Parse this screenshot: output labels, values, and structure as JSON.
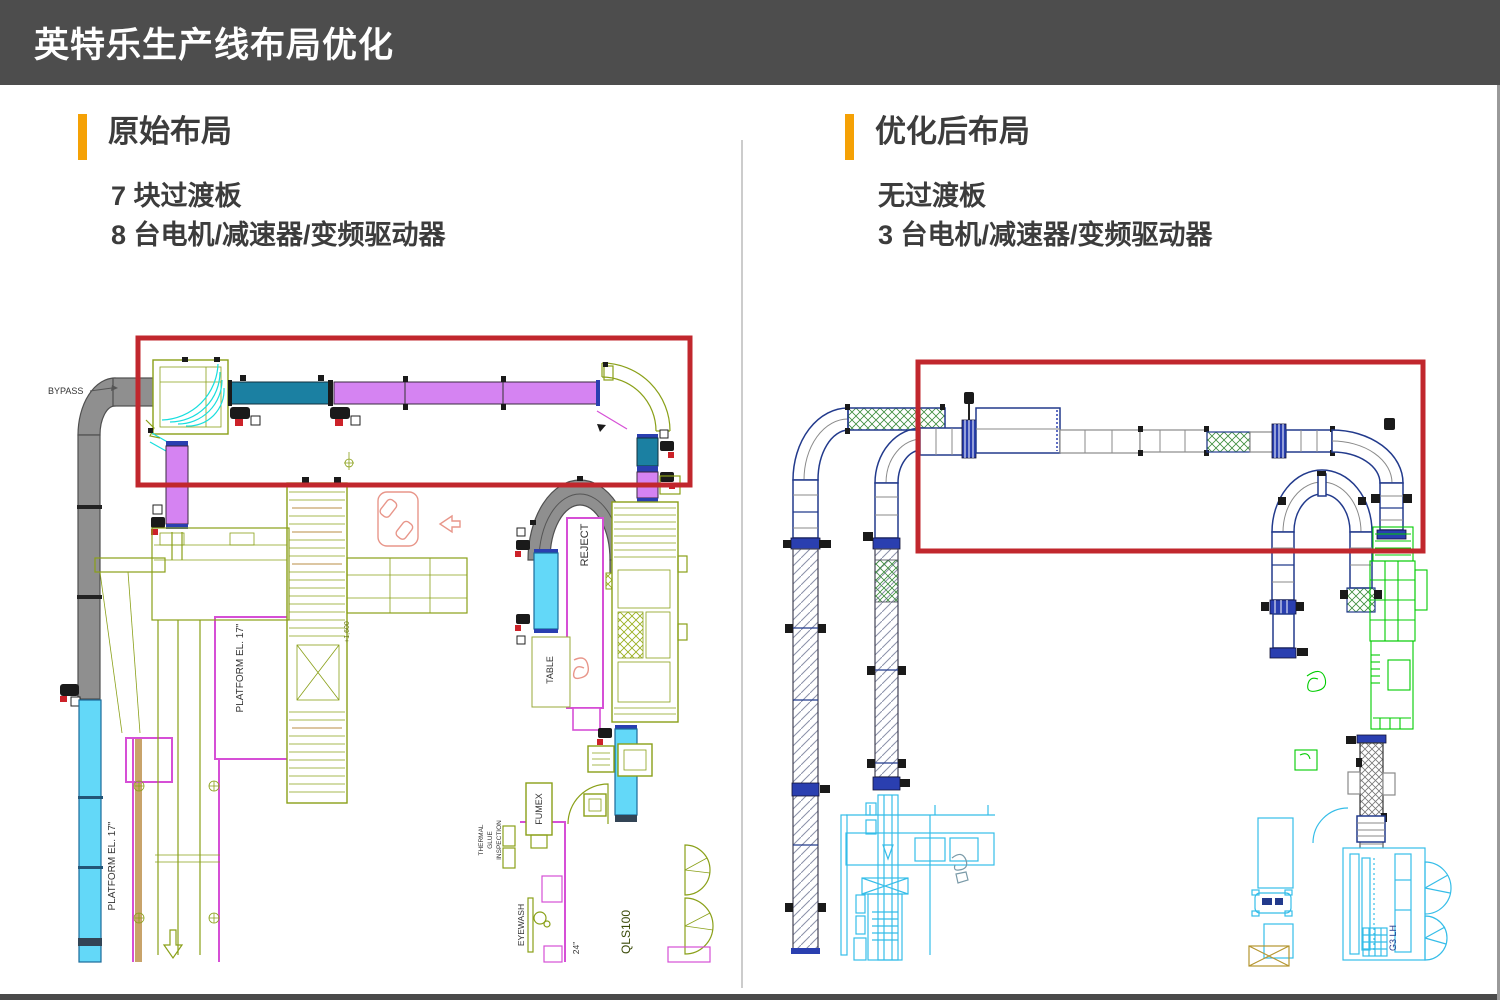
{
  "header": {
    "title": "英特乐生产线布局优化"
  },
  "panels": {
    "original": {
      "heading": "原始布局",
      "bullets": [
        "7 块过渡板",
        "8 台电机/减速器/变频驱动器"
      ],
      "cad_labels": {
        "bypass": "BYPASS",
        "platform_upper": "PLATFORM EL. 17\"",
        "platform_lower": "PLATFORM EL. 17\"",
        "reject": "REJECT",
        "table": "TABLE",
        "fumex": "FUMEX",
        "thermal_line1": "THERMAL",
        "thermal_line2": "GLUE",
        "thermal_line3": "INSPECTION",
        "eyewash": "EYEWASH",
        "width_24": "24\"",
        "machine": "QLS100",
        "elevation": "+1,600"
      }
    },
    "optimized": {
      "heading": "优化后布局",
      "bullets": [
        "无过渡板",
        "3 台电机/减速器/变频驱动器"
      ],
      "cad_labels": {
        "machine": "G3 LH"
      }
    }
  },
  "colors": {
    "header_bg": "#4d4d4d",
    "accent_orange": "#f5a105",
    "highlight_red": "#c1272d",
    "conveyor_gray": "#8f8f8f",
    "conveyor_cyan": "#63d8f8",
    "conveyor_teal": "#1b80a2",
    "conveyor_magenta": "#d583f2",
    "cad_olive": "#8aa018",
    "cad_pink": "#d64fd6",
    "cad_navy": "#223a8c",
    "cad_green": "#00cc00",
    "cad_cyan": "#35bde8"
  }
}
